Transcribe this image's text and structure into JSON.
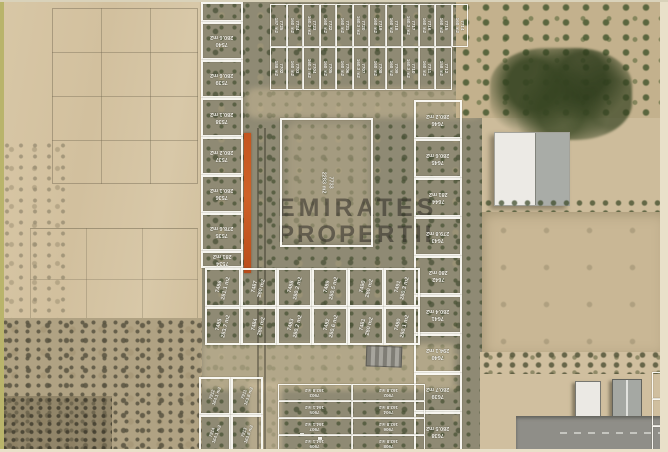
{
  "watermark": {
    "line1": "EMIRATES",
    "line2": "PROPERTIE"
  },
  "highlight": {
    "name": "highlighted-plot-strip",
    "color": "#c4551f"
  },
  "plots": {
    "left_column": {
      "cells": [
        {
          "n": "",
          "a": ""
        },
        {
          "n": "7540",
          "a": "280.6 m2"
        },
        {
          "n": "7539",
          "a": "280.6 m2"
        },
        {
          "n": "7538",
          "a": "280.1 m2"
        },
        {
          "n": "7537",
          "a": "280.2 m2"
        },
        {
          "n": "7536",
          "a": "280.1 m2"
        },
        {
          "n": "7535",
          "a": "278.6 m2"
        },
        {
          "n": "7534",
          "a": "281 m2"
        }
      ]
    },
    "top_grid": {
      "cells": [
        {
          "n": "7725",
          "a": "187 m2"
        },
        {
          "n": "7724",
          "a": "160 m2"
        },
        {
          "n": "7723",
          "a": "160.3 m2"
        },
        {
          "n": "7722",
          "a": "160 m2"
        },
        {
          "n": "7721",
          "a": "160 m2"
        },
        {
          "n": "7720",
          "a": "160.3 m2"
        },
        {
          "n": "7719",
          "a": "160 m2"
        },
        {
          "n": "7718",
          "a": "160 m2"
        },
        {
          "n": "7717",
          "a": "160.3 m2"
        },
        {
          "n": "7716",
          "a": "160 m2"
        },
        {
          "n": "7715",
          "a": "160 m2"
        },
        {
          "n": "7714",
          "a": "160 m2"
        },
        {
          "n": "7702",
          "a": "188 m2"
        },
        {
          "n": "7703",
          "a": "160 m2"
        },
        {
          "n": "7704",
          "a": "160.3 m2"
        },
        {
          "n": "7705",
          "a": "160 m2"
        },
        {
          "n": "7706",
          "a": "160 m2"
        },
        {
          "n": "7707",
          "a": "160.3 m2"
        },
        {
          "n": "7708",
          "a": "160 m2"
        },
        {
          "n": "7709",
          "a": "160 m2"
        },
        {
          "n": "7710",
          "a": "160.3 m2"
        },
        {
          "n": "7711",
          "a": "160 m2"
        },
        {
          "n": "7712",
          "a": "158 m2"
        }
      ]
    },
    "center_plot": {
      "cells": [
        {
          "n": "7733",
          "a": "2283 m2"
        }
      ]
    },
    "right_column": {
      "cells": [
        {
          "n": "7646",
          "a": "280.2 m2"
        },
        {
          "n": "7645",
          "a": "280.6 m2"
        },
        {
          "n": "7644",
          "a": "281 m2"
        },
        {
          "n": "7643",
          "a": "279.8 m2"
        },
        {
          "n": "7642",
          "a": "280 m2"
        },
        {
          "n": "7641",
          "a": "280.4 m2"
        },
        {
          "n": "7640",
          "a": "294.1 m2"
        },
        {
          "n": "7639",
          "a": "280.7 m2"
        },
        {
          "n": "7638",
          "a": "280.5 m2"
        }
      ]
    },
    "mid_grid": {
      "cells": [
        {
          "n": "7486",
          "a": "281.1 m2"
        },
        {
          "n": "7487",
          "a": "280 m2"
        },
        {
          "n": "7488",
          "a": "280.2 m2"
        },
        {
          "n": "7489",
          "a": "280.5 m2"
        },
        {
          "n": "7490",
          "a": "280 m2"
        },
        {
          "n": "7491",
          "a": "280.3 m2"
        },
        {
          "n": "7485",
          "a": "283.7 m2"
        },
        {
          "n": "7484",
          "a": "280 m2"
        },
        {
          "n": "7483",
          "a": "280.2 m2"
        },
        {
          "n": "7482",
          "a": "280.6 m2"
        },
        {
          "n": "7481",
          "a": "280 m2"
        },
        {
          "n": "7480",
          "a": "280.1 m2"
        }
      ]
    },
    "bottom_center_grid": {
      "cells": [
        {
          "n": "7903",
          "a": "163.8 m2"
        },
        {
          "n": "7902",
          "a": "163.8 m2"
        },
        {
          "n": "7905",
          "a": "164.1 m2"
        },
        {
          "n": "7904",
          "a": "163.8 m2"
        },
        {
          "n": "7907",
          "a": "164.1 m2"
        },
        {
          "n": "7906",
          "a": "163.8 m2"
        },
        {
          "n": "7909",
          "a": "164.1 m2"
        },
        {
          "n": "7908",
          "a": "163.8 m2"
        }
      ]
    },
    "bottom_left_grid": {
      "cells": [
        {
          "n": "7912",
          "a": "164.1 m2"
        },
        {
          "n": "7911",
          "a": "163.8 m2"
        },
        {
          "n": "7914",
          "a": "164.1 m2"
        },
        {
          "n": "7913",
          "a": "163.8 m2"
        }
      ]
    },
    "right_edge_partial": {
      "cells": [
        {
          "n": "",
          "a": ""
        },
        {
          "n": "",
          "a": ""
        },
        {
          "n": "",
          "a": ""
        }
      ]
    }
  }
}
